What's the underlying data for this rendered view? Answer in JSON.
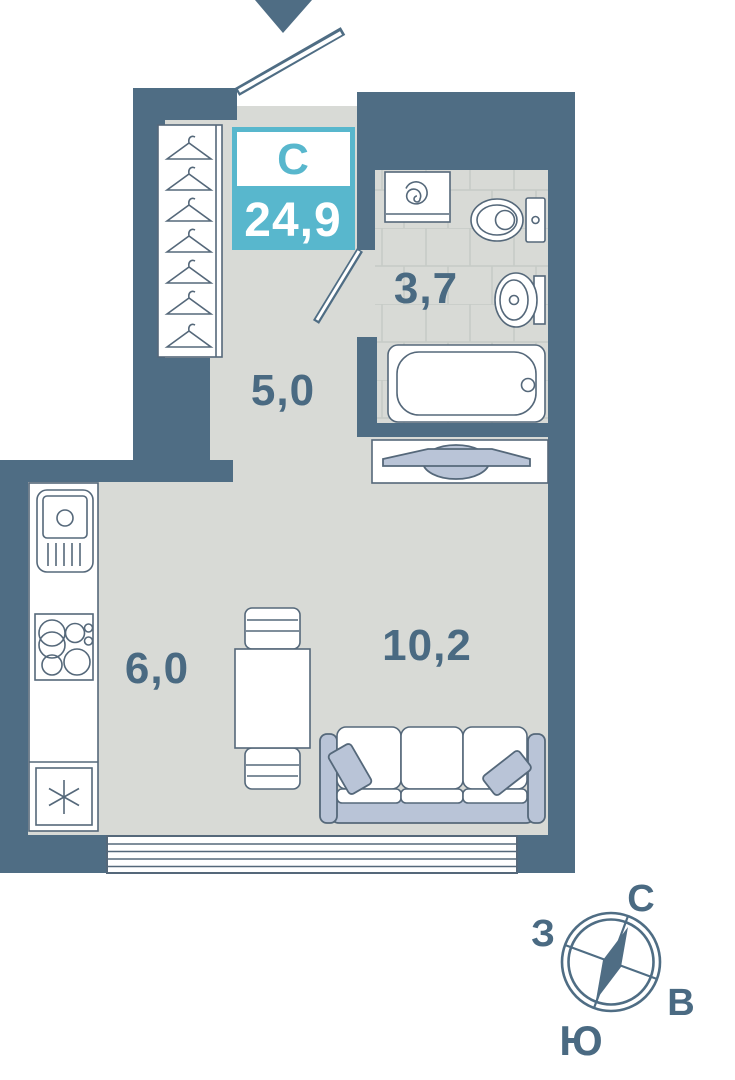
{
  "plan": {
    "unit_type_label": "С",
    "total_area": "24,9",
    "rooms": {
      "hallway": "5,0",
      "bathroom": "3,7",
      "kitchen": "6,0",
      "living": "10,2"
    }
  },
  "compass": {
    "north": "С",
    "west": "З",
    "east": "В",
    "south": "Ю"
  },
  "colors": {
    "wall": "#4f6d84",
    "accent": "#58b7cd",
    "floor": "#d8dad6",
    "tile": "#c6cbc6",
    "line": "#55687a",
    "soft": "#b9c4d7",
    "label": "#4a6a82",
    "paper": "#ffffff"
  }
}
